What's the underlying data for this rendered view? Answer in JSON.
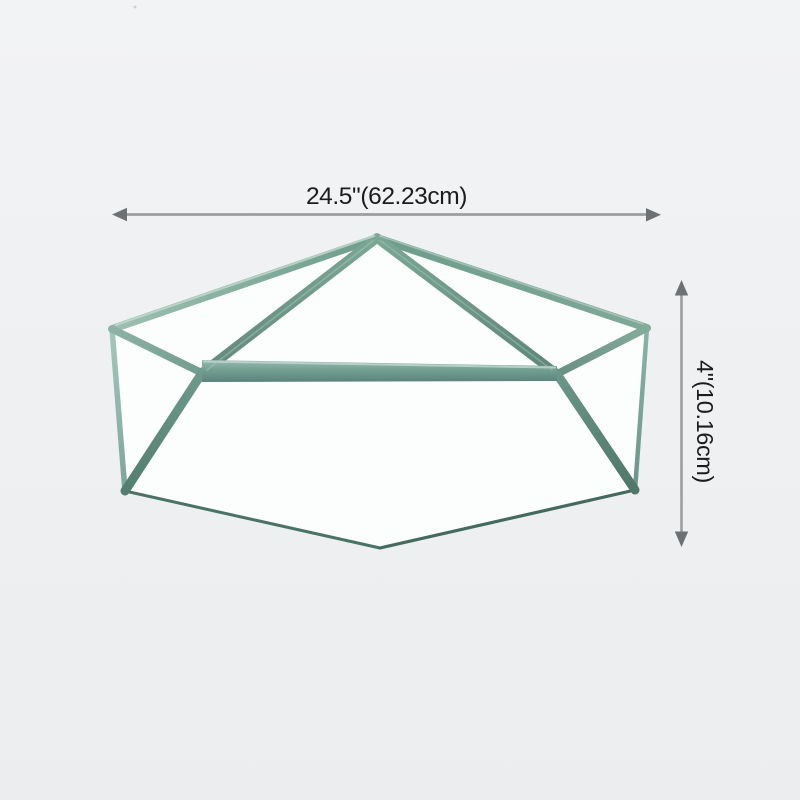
{
  "diagram": {
    "width_dimension": {
      "label": "24.5\"(62.23cm)"
    },
    "height_dimension": {
      "label": "4\"(10.16cm)"
    }
  },
  "style": {
    "background_top": "#f2f3f5",
    "background_bottom": "#ebedef",
    "panel_color": "#fcfdfd",
    "frame_light": "#a6c6bd",
    "frame_mid": "#74a193",
    "frame_dark": "#537d6f",
    "frame_deep": "#446a5e",
    "dimension_line_color": "#9b9da0",
    "arrow_color": "#6e7174",
    "label_color": "#1c1c1e"
  }
}
